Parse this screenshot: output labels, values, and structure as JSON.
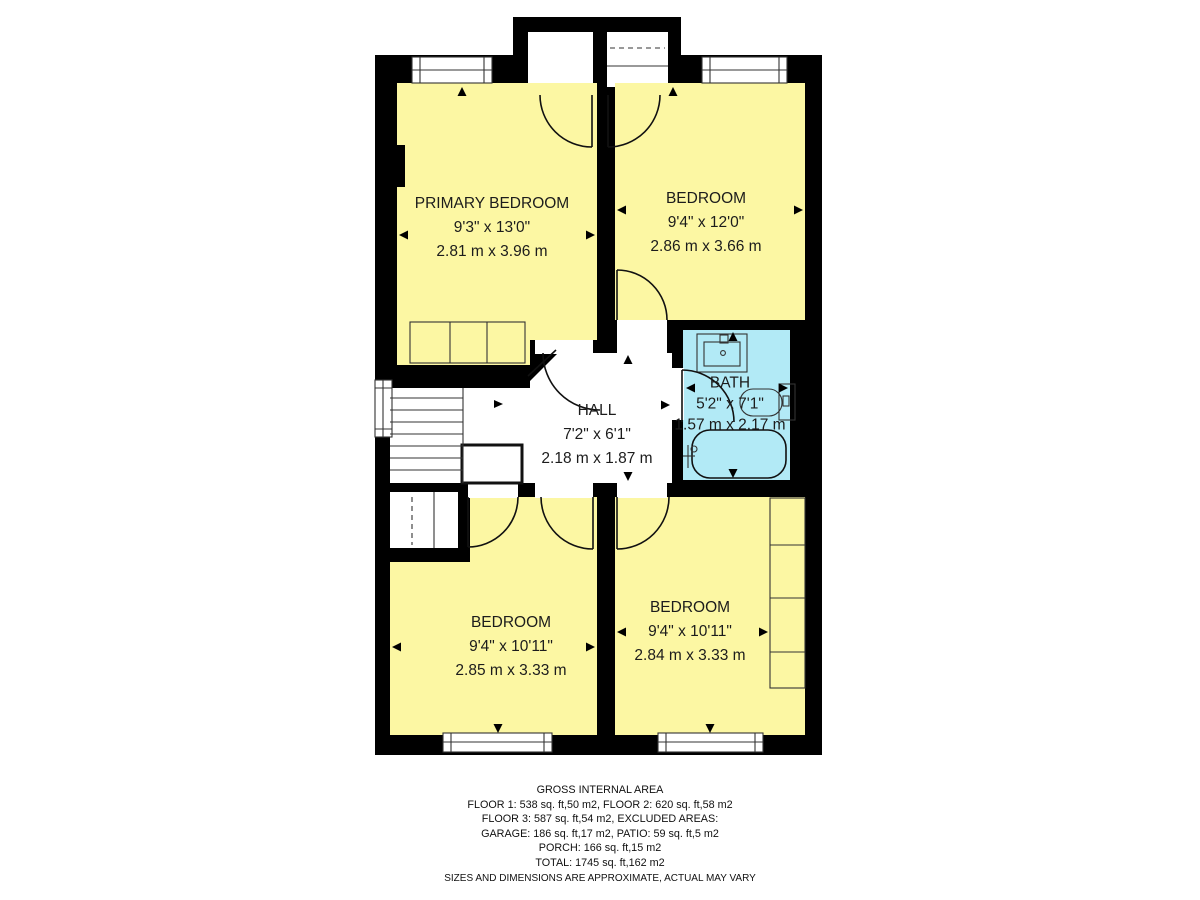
{
  "plan": {
    "rooms": {
      "primary_bedroom": {
        "name": "PRIMARY BEDROOM",
        "imperial": "9'3\" x 13'0\"",
        "metric": "2.81 m x 3.96 m"
      },
      "bedroom_top_right": {
        "name": "BEDROOM",
        "imperial": "9'4\" x 12'0\"",
        "metric": "2.86 m x 3.66 m"
      },
      "hall": {
        "name": "HALL",
        "imperial": "7'2\" x 6'1\"",
        "metric": "2.18 m x 1.87 m"
      },
      "bath": {
        "name": "BATH",
        "imperial": "5'2\" x 7'1\"",
        "metric": "1.57 m x 2.17 m"
      },
      "bedroom_bottom_left": {
        "name": "BEDROOM",
        "imperial": "9'4\" x 10'11\"",
        "metric": "2.85 m x 3.33 m"
      },
      "bedroom_bottom_right": {
        "name": "BEDROOM",
        "imperial": "9'4\" x 10'11\"",
        "metric": "2.84 m x 3.33 m"
      }
    },
    "colors": {
      "wall": "#000000",
      "room_fill": "#fcf7a3",
      "bath_fill": "#b2eaf6",
      "floor_white": "#ffffff"
    }
  },
  "footer": {
    "title": "GROSS INTERNAL AREA",
    "line1": "FLOOR 1: 538 sq. ft,50 m2, FLOOR 2: 620 sq. ft,58 m2",
    "line2": "FLOOR 3: 587 sq. ft,54 m2, EXCLUDED AREAS:",
    "line3": "GARAGE: 186 sq. ft,17 m2, PATIO: 59 sq. ft,5 m2",
    "line4": "PORCH: 166 sq. ft,15 m2",
    "line5": "TOTAL: 1745 sq. ft,162 m2",
    "disclaimer": "SIZES AND DIMENSIONS ARE APPROXIMATE, ACTUAL MAY VARY"
  }
}
